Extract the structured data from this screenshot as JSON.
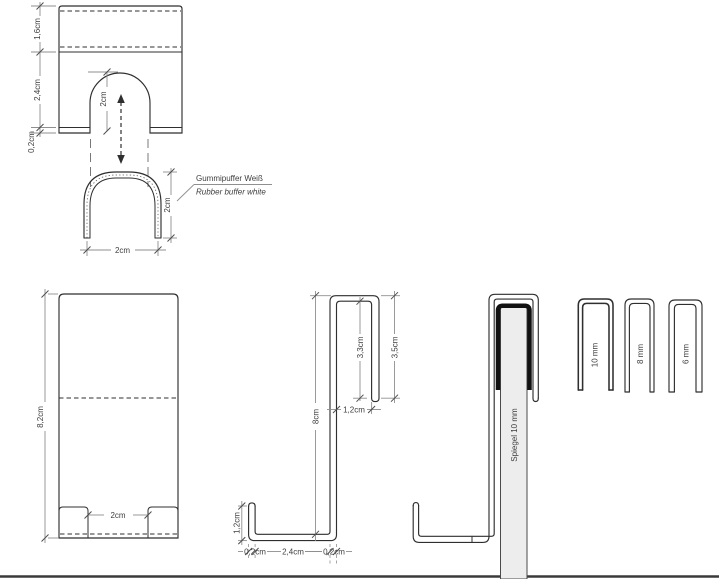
{
  "colors": {
    "line": "#2f2f2f",
    "dim_line": "#8f8f8f",
    "label_text": "#3d3d3d",
    "mirror_fill": "#ededed",
    "buffer_black": "#111111",
    "ground_line": "#3a3a3a"
  },
  "front_view": {
    "d_top": "1,6cm",
    "d_mid": "2,4cm",
    "d_lip": "0,2cm",
    "d_arch": "2cm"
  },
  "buffer": {
    "name_de": "Gummipuffer Weiß",
    "name_en": "Rubber buffer white",
    "d_height": "2cm",
    "d_width": "2cm"
  },
  "front_tall": {
    "d_height": "8,2cm",
    "d_gap": "2cm"
  },
  "profile": {
    "d_height": "8cm",
    "d_hook_inner": "3,3cm",
    "d_hook_outer": "3,5cm",
    "d_gap": "1,2cm",
    "d_lip": "1,2cm",
    "d_t_left": "0,2cm",
    "d_base": "2,4cm",
    "d_t_right": "0,2cm"
  },
  "mirror": {
    "label": "Spiegel 10 mm"
  },
  "hook_sizes": [
    "10 mm",
    "8 mm",
    "6 mm"
  ]
}
